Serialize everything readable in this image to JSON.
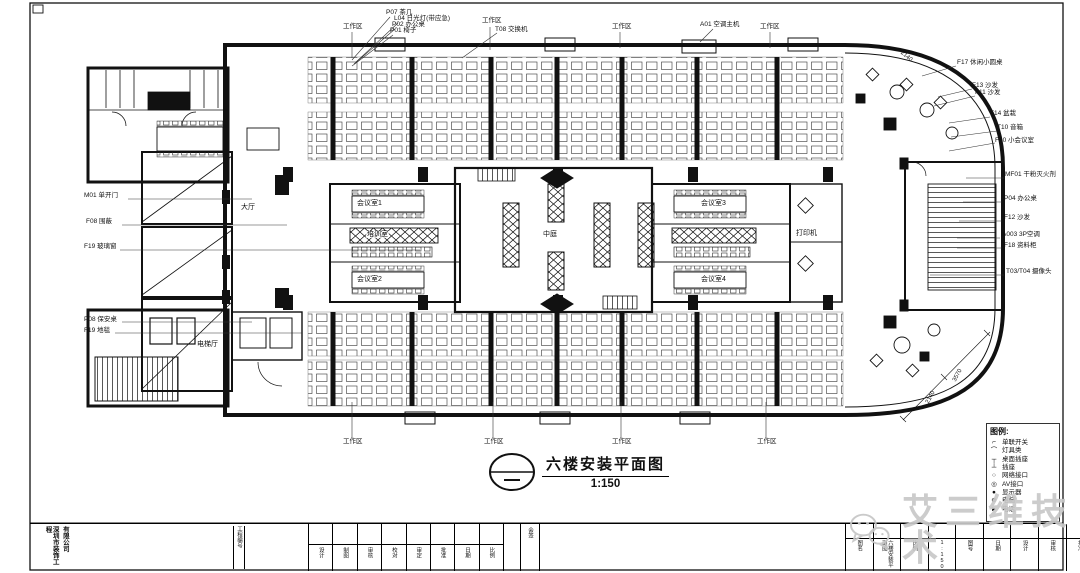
{
  "page": {
    "background": "#ffffff",
    "ink": "#111111",
    "watermark_color": "#c8c8c8"
  },
  "plan_title": {
    "text": "六楼安装平面图",
    "scale": "1:150"
  },
  "labels": {
    "ws_top_1": "工作区",
    "ws_top_2": "工作区",
    "ws_top_3": "工作区",
    "ws_top_4": "工作区",
    "ws_bottom_1": "工作区",
    "ws_bottom_2": "工作区",
    "ws_bottom_3": "工作区",
    "ws_bottom_4": "工作区",
    "p07": "P07 茶几",
    "l04": "L04 日光灯(带应急)",
    "p02": "P02 办公桌",
    "p01": "P01 椅子",
    "t08": "T08 交换机",
    "a01": "A01 空调主机",
    "f17": "F17 休闲小圆桌",
    "f13": "F13 沙发",
    "f11": "F11 沙发",
    "f14": "F14 盆栽",
    "t10": "T10 音箱",
    "f10": "F10 小会议室",
    "mf01": "MF01 干粉灭火剂",
    "p04": "P04 办公桌",
    "f12": "F12 沙发",
    "a003": "A003 3P空调",
    "f18": "F18 资料柜",
    "t03": "T03/T04 摄像头",
    "m01": "M01 单开门",
    "f08": "F08 围蔽",
    "f19": "F19 玻璃窗",
    "p08": "P08 保安桌",
    "f19b": "F19 地毯",
    "hall": "大厅",
    "elevator_hall": "电梯厅",
    "meeting1": "会议室1",
    "meeting2": "会议室2",
    "meeting3": "会议室3",
    "meeting4": "会议室4",
    "training": "培训室",
    "printer": "打印机",
    "atrium": "中庭",
    "dim_1": "2140",
    "dim_2": "3570",
    "dim_3": "2140"
  },
  "legend": {
    "title": "图例:",
    "items": [
      {
        "symbol": "⌐",
        "label": "单联开关"
      },
      {
        "symbol": "⌒",
        "label": "灯具类"
      },
      {
        "symbol": "┬",
        "label": "桌面插座"
      },
      {
        "symbol": "┴",
        "label": "插座"
      },
      {
        "symbol": "○",
        "label": "网络接口"
      },
      {
        "symbol": "◎",
        "label": "AV接口"
      },
      {
        "symbol": "●",
        "label": "显示器"
      },
      {
        "symbol": "⊕",
        "label": "电脑"
      },
      {
        "symbol": "►",
        "label": "电话"
      }
    ]
  },
  "title_block": {
    "company_line1": "深圳市装饰工程",
    "company_line2": "有限公司",
    "project_no": "工程编号",
    "sign_fields": [
      "设计",
      "制图",
      "审核",
      "校对",
      "审定",
      "批准",
      "日期",
      "比例"
    ],
    "countersign": "会签",
    "right_fields": [
      "图名",
      "六楼安装平面图",
      "比例",
      "1:150",
      "图号",
      "日期",
      "设计",
      "审核",
      "批准"
    ]
  },
  "watermark": {
    "text": "艾三维技术"
  }
}
